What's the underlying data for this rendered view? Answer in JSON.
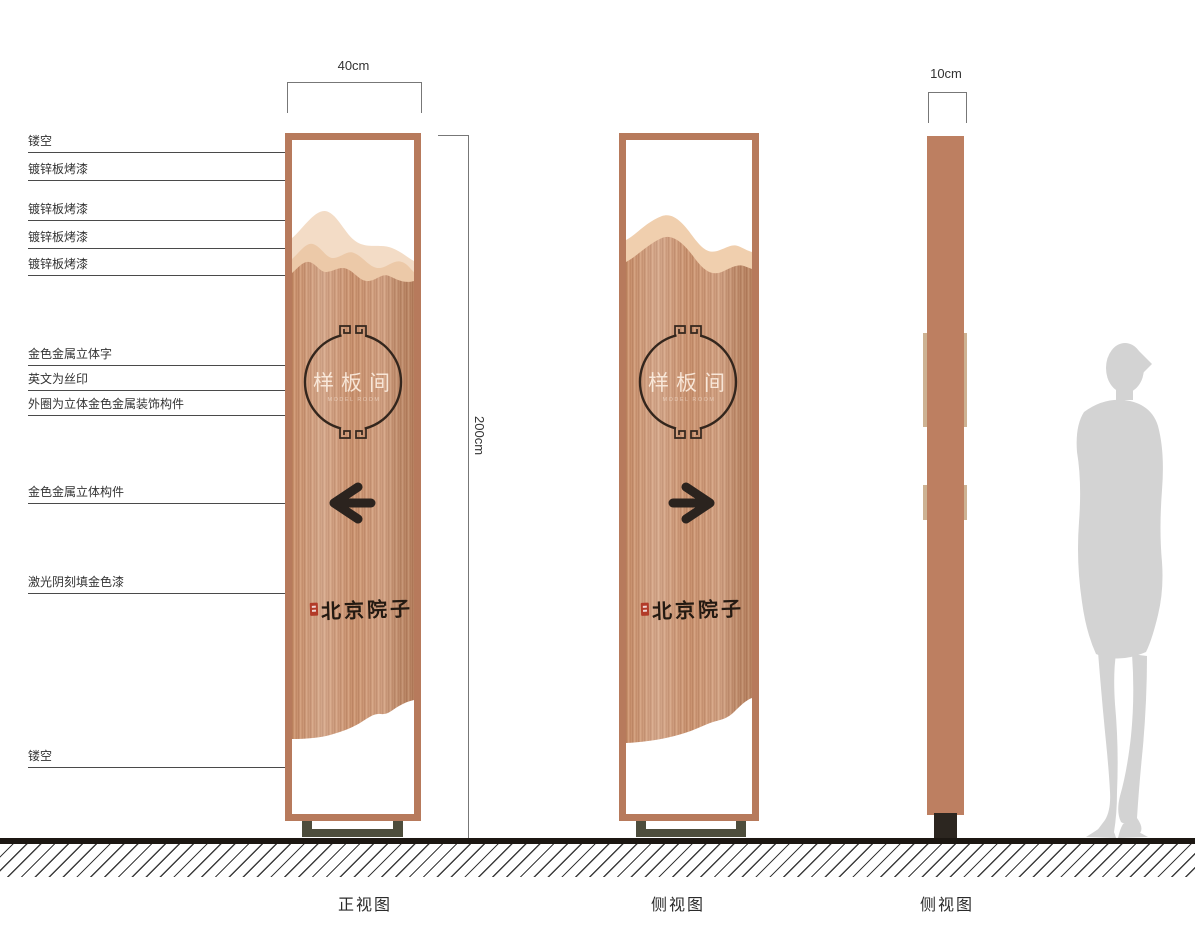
{
  "annotations": [
    "镂空",
    "镀锌板烤漆",
    "镀锌板烤漆",
    "镀锌板烤漆",
    "镀锌板烤漆",
    "金色金属立体字",
    "英文为丝印",
    "外圈为立体金色金属装饰构件",
    "金色金属立体构件",
    "激光阴刻填金色漆",
    "镂空"
  ],
  "dimensions": {
    "front_width": "40cm",
    "side_width": "10cm",
    "height": "200cm"
  },
  "views": {
    "front": "正视图",
    "side": "侧视图",
    "side2": "侧视图"
  },
  "panel": {
    "title": "样板间",
    "subtitle": "MODEL ROOM",
    "brand": "北京院子"
  },
  "colors": {
    "frame": "#b77a5c",
    "wood_base": "#c78e6a",
    "mountain_light": "#f3dcc6",
    "mountain_mid": "#ecc9a8",
    "ornament_dark": "#33261d",
    "arrow_dark": "#2b231e",
    "seal_red": "#b23b28",
    "base_olive": "#4d4d3c",
    "side_base_dark": "#2c2620",
    "silhouette_gray": "#d3d3d3"
  }
}
